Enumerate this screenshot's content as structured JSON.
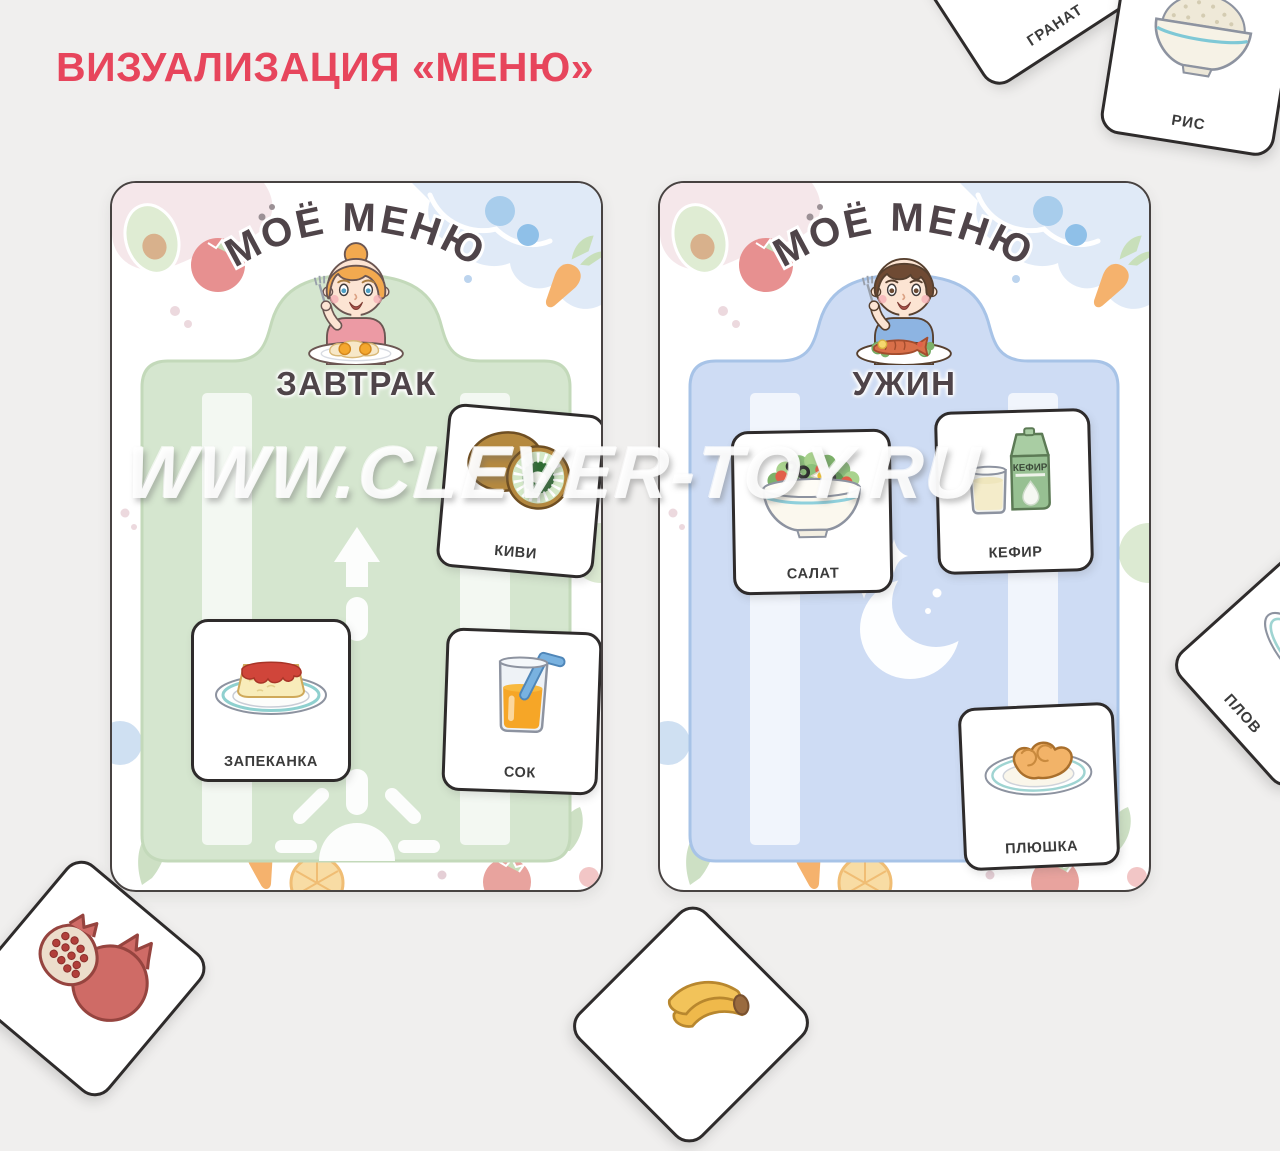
{
  "page": {
    "title": "ВИЗУАЛИЗАЦИЯ «МЕНЮ»",
    "title_color": "#e7455c",
    "background": "#f0efee",
    "watermark": "WWW.CLEVER-TOY.RU"
  },
  "boards": [
    {
      "menu_title": "МОЁ МЕНЮ",
      "meal_label": "ЗАВТРАК",
      "character": "girl-eating-fried-eggs",
      "panel_color": "#d5e6cf",
      "ornament": "sunrise-arrow",
      "cards": [
        {
          "label": "КИВИ",
          "art": "kiwi"
        },
        {
          "label": "ЗАПЕКАНКА",
          "art": "casserole-plate"
        },
        {
          "label": "СОК",
          "art": "juice-glass"
        }
      ]
    },
    {
      "menu_title": "МОЁ МЕНЮ",
      "meal_label": "УЖИН",
      "character": "boy-eating-fish-dinner",
      "panel_color": "#cedcf4",
      "ornament": "moon-and-stars",
      "cards": [
        {
          "label": "САЛАТ",
          "art": "salad-bowl"
        },
        {
          "label": "КЕФИР",
          "art": "kefir-carton-glass",
          "carton_text": "КЕФИР"
        },
        {
          "label": "ПЛЮШКА",
          "art": "sweet-bun-plate"
        }
      ]
    }
  ],
  "scattered_cards": [
    {
      "label": "ГРАНАТ",
      "art": "pomegranate"
    },
    {
      "label": "РИС",
      "art": "rice-bowl"
    },
    {
      "label": "ПЛОВ",
      "art": "pilaf-plate"
    },
    {
      "label": "",
      "art": "pomegranate-partial"
    },
    {
      "label": "",
      "art": "banana-partial"
    }
  ]
}
